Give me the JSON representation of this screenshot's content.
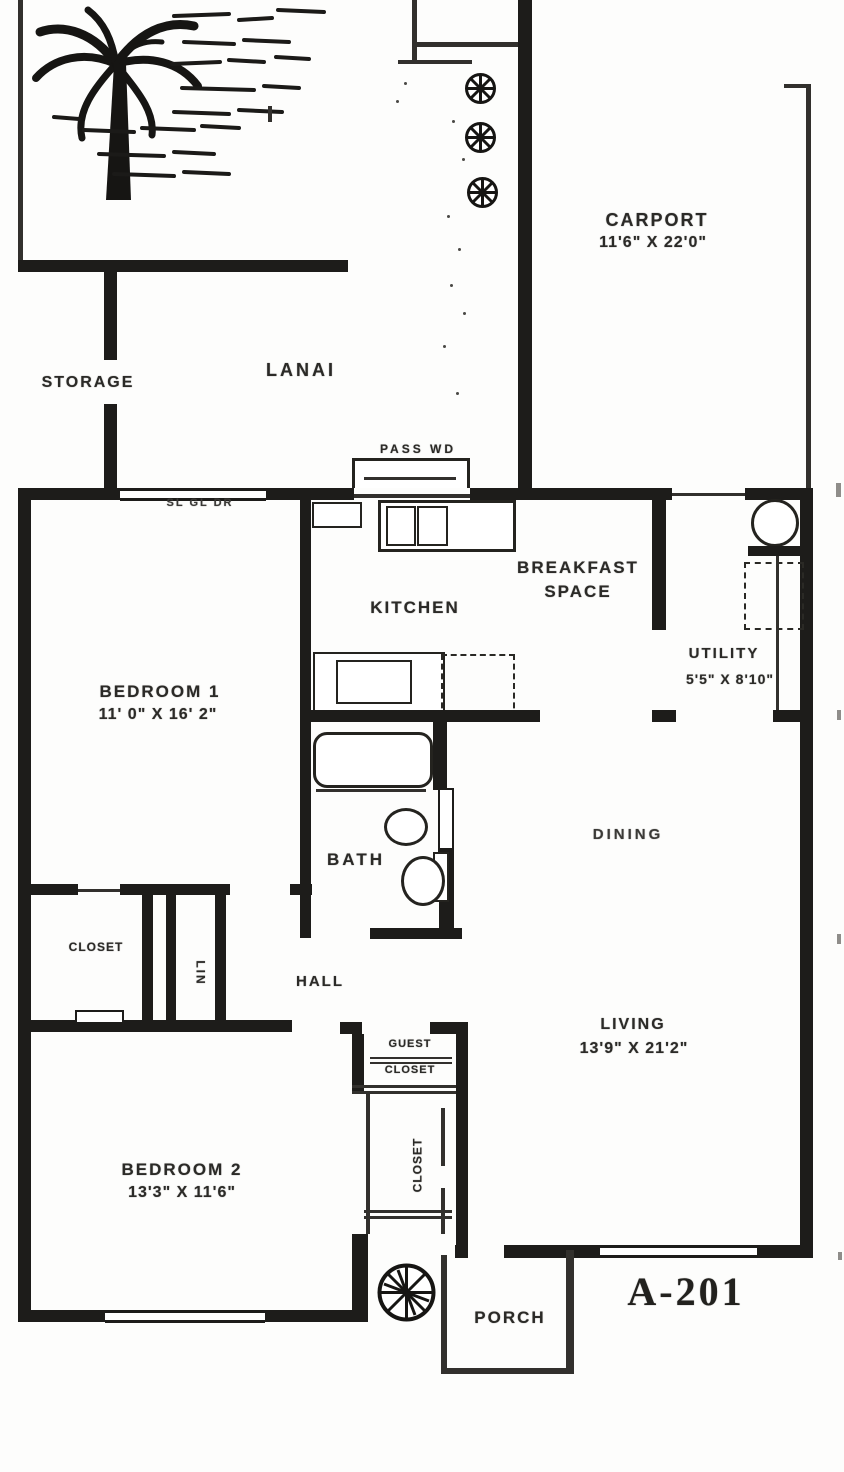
{
  "plan": {
    "unit_number": "A-201",
    "rooms": {
      "carport": {
        "name": "CARPORT",
        "dims": "11'6\" X 22'0\""
      },
      "storage": {
        "name": "STORAGE"
      },
      "lanai": {
        "name": "LANAI"
      },
      "kitchen": {
        "name": "KITCHEN"
      },
      "breakfast": {
        "name_line1": "BREAKFAST",
        "name_line2": "SPACE"
      },
      "utility": {
        "name": "UTILITY",
        "dims": "5'5\" X 8'10\""
      },
      "bedroom1": {
        "name": "BEDROOM 1",
        "dims": "11' 0\" X 16' 2\""
      },
      "bath": {
        "name": "BATH"
      },
      "dining": {
        "name": "DINING"
      },
      "closet1": {
        "name": "CLOSET"
      },
      "linen_closet": {
        "name": "LIN"
      },
      "hall": {
        "name": "HALL"
      },
      "living": {
        "name": "LIVING",
        "dims": "13'9\" X 21'2\""
      },
      "guest_closet": {
        "name_line1": "GUEST",
        "name_line2": "CLOSET"
      },
      "closet2": {
        "name": "CLOSET"
      },
      "bedroom2": {
        "name": "BEDROOM 2",
        "dims": "13'3\" X 11'6\""
      },
      "porch": {
        "name": "PORCH"
      }
    },
    "annotations": {
      "pass_window": "PASS WD",
      "sliding_glass_door": "SL GL DR"
    }
  }
}
